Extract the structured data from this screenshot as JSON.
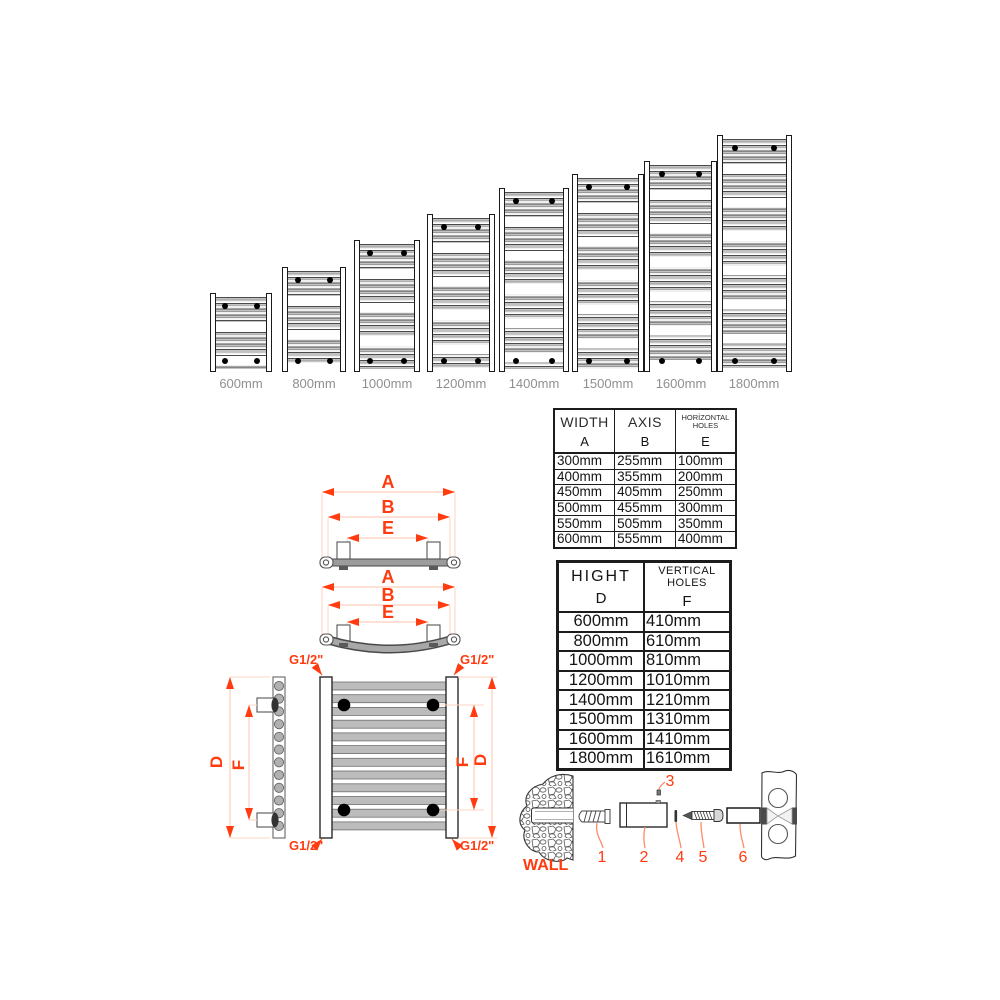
{
  "accent_color": "#ff3b0f",
  "dimension_line_color": "#ffd2c2",
  "leader_line_color": "#ff8a66",
  "size_label_color": "#8f8f8f",
  "radiator_chart": {
    "bottom_labels": [
      "600mm",
      "800mm",
      "1000mm",
      "1200mm",
      "1400mm",
      "1500mm",
      "1600mm",
      "1800mm"
    ],
    "heights_mm": [
      600,
      800,
      1000,
      1200,
      1400,
      1500,
      1600,
      1800
    ]
  },
  "width_table": {
    "columns": [
      {
        "name": "WIDTH",
        "letter": "A"
      },
      {
        "name": "AXIS",
        "letter": "B"
      },
      {
        "name": "HORİZONTAL HOLES",
        "letter": "E"
      }
    ],
    "rows": [
      [
        "300mm",
        "255mm",
        "100mm"
      ],
      [
        "400mm",
        "355mm",
        "200mm"
      ],
      [
        "450mm",
        "405mm",
        "250mm"
      ],
      [
        "500mm",
        "455mm",
        "300mm"
      ],
      [
        "550mm",
        "505mm",
        "350mm"
      ],
      [
        "600mm",
        "555mm",
        "400mm"
      ]
    ]
  },
  "height_table": {
    "columns": [
      {
        "name": "HIGHT",
        "letter": "D"
      },
      {
        "name": "VERTICAL HOLES",
        "letter": "F"
      }
    ],
    "rows": [
      [
        "600mm",
        "410mm"
      ],
      [
        "800mm",
        "610mm"
      ],
      [
        "1000mm",
        "810mm"
      ],
      [
        "1200mm",
        "1010mm"
      ],
      [
        "1400mm",
        "1210mm"
      ],
      [
        "1500mm",
        "1310mm"
      ],
      [
        "1600mm",
        "1410mm"
      ],
      [
        "1800mm",
        "1610mm"
      ]
    ]
  },
  "dimension_labels": {
    "A": "A",
    "B": "B",
    "E": "E",
    "D": "D",
    "F": "F",
    "connection": "G1/2\""
  },
  "hardware": {
    "wall": "WALL",
    "parts": [
      "1",
      "2",
      "3",
      "4",
      "5",
      "6"
    ]
  }
}
